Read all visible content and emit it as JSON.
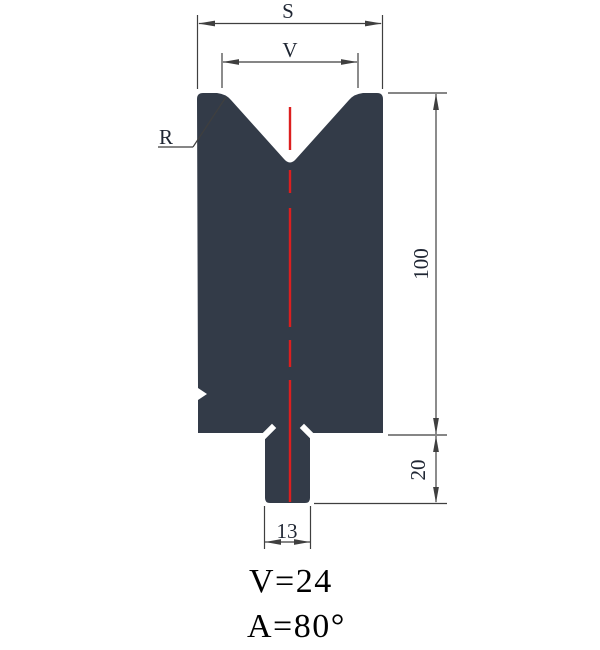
{
  "diagram": {
    "type": "press-brake-die-technical-drawing",
    "colors": {
      "body_fill": "#333b48",
      "centerline": "#dc1f1f",
      "dimension_line": "#3f3f3f",
      "dimension_text": "#1f2633",
      "caption_text": "#000000"
    },
    "dimensions": {
      "top_width_label": "S",
      "v_opening_label": "V",
      "radius_label": "R",
      "body_height": "100",
      "shank_height": "20",
      "shank_width": "13"
    },
    "caption": {
      "v_value": "V=24",
      "angle_value": "A=80°"
    }
  }
}
